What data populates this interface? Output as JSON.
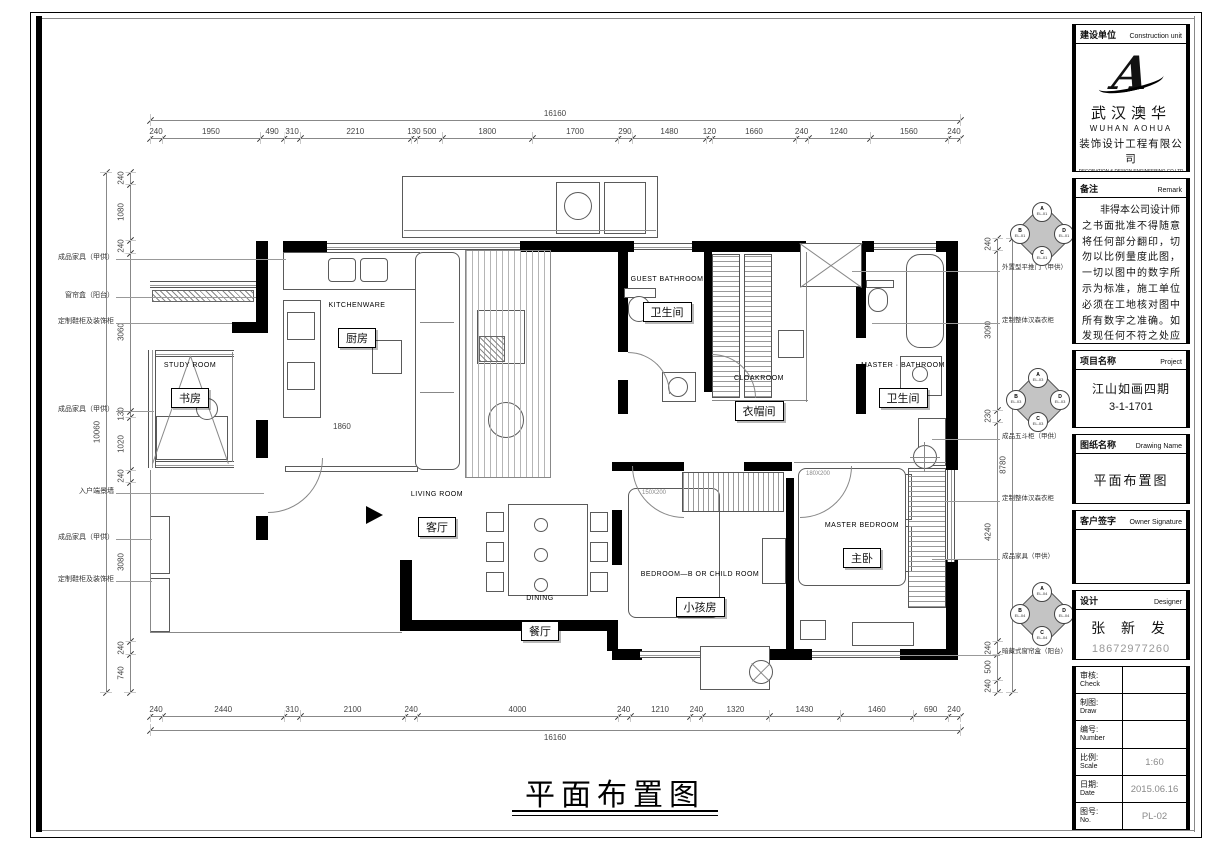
{
  "page": {
    "bottom_title": "平面布置图"
  },
  "title_block": {
    "construction_unit": {
      "label_cn": "建设单位",
      "label_en": "Construction unit",
      "logo_letter": "A",
      "company_cn": "武汉澳华",
      "company_en": "WUHAN  AOHUA",
      "company_line2": "装饰设计工程有限公司",
      "company_line3": "DECORATION & DESIGN ENGINEERING CO.LTD"
    },
    "remark": {
      "label_cn": "备注",
      "label_en": "Remark",
      "text": "非得本公司设计师之书面批准不得随意将任何部分翻印，切勿以比例量度此图，一切以图中的数字所示为标准，施工单位必须在工地核对图中所有数字之准确。如发现任何不符之处应通知设计师，方可施工，否则施工单位必须承担所有责任。"
    },
    "project": {
      "label_cn": "项目名称",
      "label_en": "Project",
      "line1": "江山如画四期",
      "line2": "3-1-1701"
    },
    "drawing_name": {
      "label_cn": "图纸名称",
      "label_en": "Drawing Name",
      "value": "平面布置图"
    },
    "owner_signature": {
      "label_cn": "客户签字",
      "label_en": "Owner Signature"
    },
    "designer": {
      "label_cn": "设计",
      "label_en": "Designer",
      "name": "张 新 发",
      "phone": "18672977260"
    },
    "info_rows": [
      {
        "label_cn": "审核:",
        "label_en": "Check",
        "value": ""
      },
      {
        "label_cn": "制图:",
        "label_en": "Draw",
        "value": ""
      },
      {
        "label_cn": "编号:",
        "label_en": "Number",
        "value": ""
      },
      {
        "label_cn": "比例:",
        "label_en": "Scale",
        "value": "1:60"
      },
      {
        "label_cn": "日期:",
        "label_en": "Date",
        "value": "2015.06.16"
      },
      {
        "label_cn": "图号:",
        "label_en": "No.",
        "value": "PL-02"
      }
    ]
  },
  "rooms": [
    {
      "en": "STUDY  ROOM",
      "cn": "书房"
    },
    {
      "en": "KITCHENWARE",
      "cn": "厨房"
    },
    {
      "en": "GUEST  BATHROOM",
      "cn": "卫生间"
    },
    {
      "en": "CLOAKROOM",
      "cn": "衣帽间"
    },
    {
      "en": "MASTER · BATHROOM",
      "cn": "卫生间"
    },
    {
      "en": "LIVING  ROOM",
      "cn": "客厅"
    },
    {
      "en": "DINING",
      "cn": "餐厅"
    },
    {
      "en": "BEDROOM—B OR CHILD ROOM",
      "cn": "小孩房"
    },
    {
      "en": "MASTER  BEDROOM",
      "cn": "主卧"
    }
  ],
  "dimensions": {
    "top": {
      "total": "16160",
      "values": [
        "240",
        "1950",
        "490",
        "310",
        "2210",
        "130",
        "500",
        "1800",
        "1700",
        "290",
        "1480",
        "120",
        "1660",
        "240",
        "1240",
        "1560",
        "240"
      ]
    },
    "bottom": {
      "total": "16160",
      "values": [
        "240",
        "2440",
        "310",
        "2100",
        "240",
        "4000",
        "240",
        "1210",
        "240",
        "1320",
        "1430",
        "1460",
        "690",
        "240"
      ]
    },
    "left": {
      "total": "10060",
      "values": [
        "240",
        "1080",
        "240",
        "3060",
        "130",
        "1020",
        "240",
        "3080",
        "240",
        "740"
      ]
    },
    "right": {
      "total": "8780",
      "values": [
        "240",
        "3090",
        "230",
        "4240",
        "240",
        "500",
        "240"
      ]
    }
  },
  "annotations": {
    "left": [
      "成品家具（甲供）",
      "窗帘盒（阳台）",
      "定制鞋柜及装饰柜",
      "成品家具（甲供）",
      "入户端景墙",
      "成品家具（甲供）",
      "定制鞋柜及装饰柜"
    ],
    "right": [
      "外置型平推门（甲供）",
      "定制整体汉森衣柜",
      "成品五斗柜（甲供）",
      "定制整体汉森衣柜",
      "成品家具（甲供）",
      "暗藏式窗帘盒（阳台）"
    ]
  },
  "plan_labels": {
    "kitchen_interior_dim": "1860",
    "child_bed_size": "150X200",
    "master_bed_size": "180X200"
  },
  "markers": [
    {
      "letters": [
        "A",
        "B",
        "D",
        "C"
      ],
      "code": "EL-01"
    },
    {
      "letters": [
        "A",
        "B",
        "D",
        "C"
      ],
      "code": "EL-03"
    },
    {
      "letters": [
        "A",
        "B",
        "D",
        "C"
      ],
      "code": "EL-04"
    }
  ]
}
